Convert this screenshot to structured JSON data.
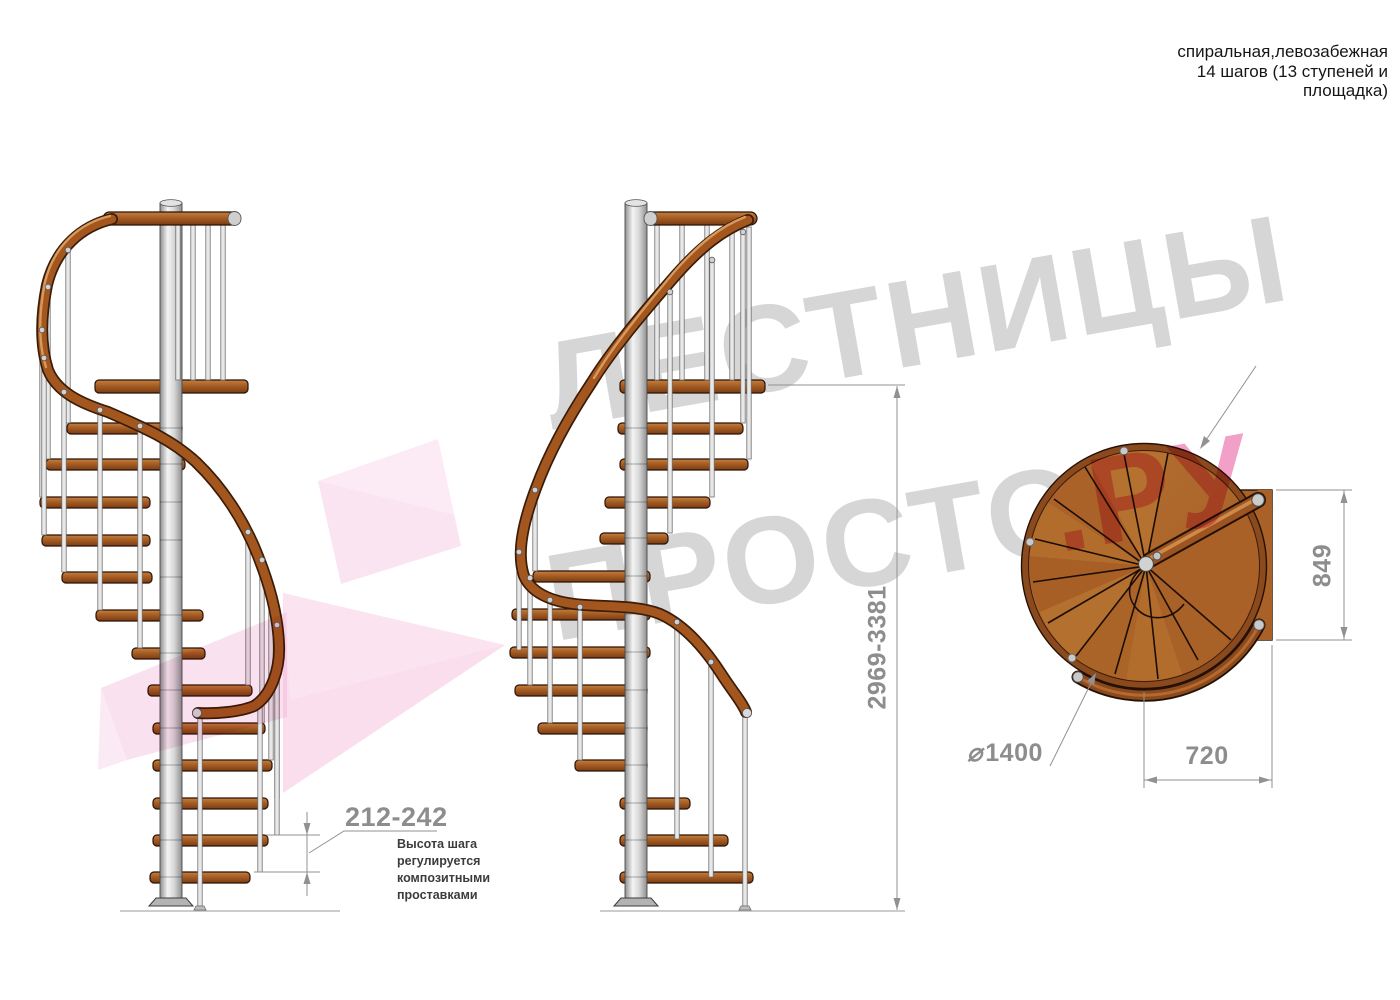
{
  "header": {
    "line1": "спиральная,левозабежная",
    "line2": "14 шагов (13 ступеней и",
    "line3": "площадка)"
  },
  "watermark": {
    "brand_top": "ЛЕСТНИЦЫ",
    "brand_bottom": "ПРОСТО",
    "brand_suffix": ".РУ"
  },
  "dimensions": {
    "step_height": {
      "value": "212-242",
      "note_lines": [
        "Высота шага",
        "регулируется",
        "композитными",
        "проставками"
      ]
    },
    "total_height": "2969-3381",
    "landing_depth": "849",
    "landing_width": "720",
    "diameter_symbol": "⌀",
    "diameter_value": "1400"
  },
  "colors": {
    "wood": "#a55d24",
    "wood_dark": "#6b3410",
    "metal": "#e8e8e8",
    "dimension_gray": "#919191",
    "watermark_gray": "#d6d6d6",
    "watermark_pink": "#f2a0c8",
    "arrow_pink": "#f1a7d0"
  }
}
